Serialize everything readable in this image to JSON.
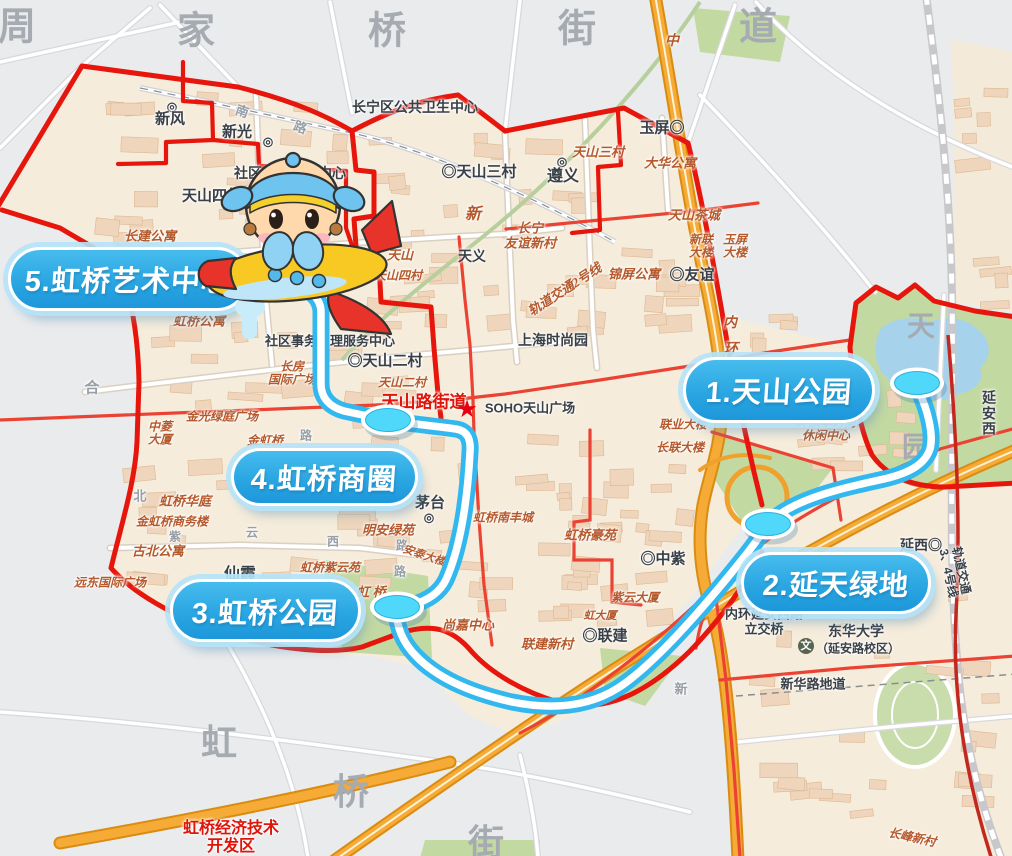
{
  "map_title": "天山路街道五站游览路线图",
  "route": {
    "stroke_color": "#32b8ee",
    "core_color": "#ffffff",
    "marker_color": "#4fd8f9",
    "path": "M 299,286 C 312,291 321,300 321,312 L 321,384 C 321,398 330,407 344,411 L 372,417 C 380,419 386,420 392,421 C 414,424 442,427 456,429 C 468,431 471,440 470,452 C 468,492 462,541 448,575 C 443,589 432,598 418,603 C 410,606 403,606 397,607 C 395,625 403,643 416,656 C 438,679 472,693 512,702 C 552,710 588,707 618,688 C 652,666 700,612 741,561 C 753,546 761,535 768,524 C 792,499 843,488 884,479 C 910,473 925,464 930,449 C 934,434 927,408 919,392",
    "stops": [
      {
        "id": 1,
        "label": "1.天山公园",
        "pill": {
          "x": 683,
          "y": 357,
          "w": 186,
          "h": 60
        },
        "marker": {
          "x": 917,
          "y": 383
        }
      },
      {
        "id": 2,
        "label": "2.延天绿地",
        "pill": {
          "x": 741,
          "y": 552,
          "w": 184,
          "h": 56
        },
        "marker": {
          "x": 768,
          "y": 524
        }
      },
      {
        "id": 3,
        "label": "3.虹桥公园",
        "pill": {
          "x": 170,
          "y": 579,
          "w": 185,
          "h": 57
        },
        "marker": {
          "x": 397,
          "y": 607
        }
      },
      {
        "id": 4,
        "label": "4.虹桥商圈",
        "pill": {
          "x": 231,
          "y": 448,
          "w": 181,
          "h": 52
        },
        "marker": {
          "x": 388,
          "y": 420
        }
      },
      {
        "id": 5,
        "label": "5.虹桥艺术中心",
        "pill": {
          "x": 8,
          "y": 247,
          "w": 235,
          "h": 58
        },
        "marker": null
      }
    ]
  },
  "mascot": {
    "type": "airplane-pilot-mascot",
    "note": "cartoon child in blue aviator cap riding yellow-red toy plane"
  },
  "labels": [
    {
      "t": "周",
      "x": 18,
      "y": 28,
      "c": "gxl",
      "s": 38
    },
    {
      "t": "家",
      "x": 197,
      "y": 32,
      "c": "gxl",
      "s": 38
    },
    {
      "t": "桥",
      "x": 388,
      "y": 32,
      "c": "gxl",
      "s": 38
    },
    {
      "t": "街",
      "x": 578,
      "y": 30,
      "c": "gxl",
      "s": 38
    },
    {
      "t": "道",
      "x": 759,
      "y": 28,
      "c": "gxl",
      "s": 38
    },
    {
      "t": "虹",
      "x": 220,
      "y": 743,
      "c": "gxl",
      "s": 36
    },
    {
      "t": "桥",
      "x": 352,
      "y": 792,
      "c": "gxl",
      "s": 36
    },
    {
      "t": "街",
      "x": 487,
      "y": 843,
      "c": "gxl",
      "s": 36
    },
    {
      "t": "天",
      "x": 922,
      "y": 327,
      "c": "gxl",
      "s": 28
    },
    {
      "t": "园",
      "x": 917,
      "y": 448,
      "c": "gxl",
      "s": 28
    },
    {
      "t": "合",
      "x": 92,
      "y": 389,
      "c": "gray",
      "s": 15
    },
    {
      "t": "南",
      "x": 242,
      "y": 112,
      "c": "gray",
      "s": 13,
      "r": 20
    },
    {
      "t": "路",
      "x": 300,
      "y": 128,
      "c": "gray",
      "s": 13,
      "r": 20
    },
    {
      "t": "北",
      "x": 140,
      "y": 497,
      "c": "gray",
      "s": 13
    },
    {
      "t": "紫",
      "x": 175,
      "y": 537,
      "c": "gray",
      "s": 12
    },
    {
      "t": "云",
      "x": 252,
      "y": 533,
      "c": "gray",
      "s": 12
    },
    {
      "t": "西",
      "x": 333,
      "y": 542,
      "c": "gray",
      "s": 12
    },
    {
      "t": "路",
      "x": 402,
      "y": 546,
      "c": "gray",
      "s": 12
    },
    {
      "t": "路",
      "x": 306,
      "y": 436,
      "c": "gray",
      "s": 12
    },
    {
      "t": "路",
      "x": 400,
      "y": 572,
      "c": "gray",
      "s": 12
    },
    {
      "t": "新",
      "x": 681,
      "y": 690,
      "c": "gray",
      "s": 13
    },
    {
      "t": "◎",
      "x": 172,
      "y": 107,
      "c": "dark",
      "s": 12
    },
    {
      "t": "新风",
      "x": 170,
      "y": 120,
      "c": "dark",
      "s": 15
    },
    {
      "t": "新光",
      "x": 237,
      "y": 133,
      "c": "dark",
      "s": 15
    },
    {
      "t": "◎",
      "x": 268,
      "y": 142,
      "c": "dark",
      "s": 12
    },
    {
      "t": "天山四村",
      "x": 212,
      "y": 197,
      "c": "dark",
      "s": 15
    },
    {
      "t": "社区卫生服务中心",
      "x": 290,
      "y": 174,
      "c": "dark",
      "s": 14
    },
    {
      "t": "长宁区公共卫生中心",
      "x": 415,
      "y": 108,
      "c": "dark",
      "s": 14
    },
    {
      "t": "◎天山三村",
      "x": 479,
      "y": 173,
      "c": "dark",
      "s": 15
    },
    {
      "t": "玉屏◎",
      "x": 662,
      "y": 129,
      "c": "dark",
      "s": 15
    },
    {
      "t": "◎",
      "x": 562,
      "y": 162,
      "c": "dark",
      "s": 12
    },
    {
      "t": "遵义",
      "x": 563,
      "y": 177,
      "c": "dark",
      "s": 16
    },
    {
      "t": "天义",
      "x": 472,
      "y": 257,
      "c": "dark",
      "s": 14
    },
    {
      "t": "◎友谊",
      "x": 692,
      "y": 276,
      "c": "dark",
      "s": 15
    },
    {
      "t": "上海时尚园",
      "x": 553,
      "y": 341,
      "c": "dark",
      "s": 14
    },
    {
      "t": "社区事务受理服务中心",
      "x": 330,
      "y": 342,
      "c": "dark",
      "s": 13
    },
    {
      "t": "◎天山二村",
      "x": 385,
      "y": 362,
      "c": "dark",
      "s": 15
    },
    {
      "t": "SOHO天山广场",
      "x": 530,
      "y": 409,
      "c": "dark",
      "s": 13
    },
    {
      "t": "茅台",
      "x": 430,
      "y": 504,
      "c": "dark",
      "s": 15
    },
    {
      "t": "◎",
      "x": 429,
      "y": 518,
      "c": "dark",
      "s": 12
    },
    {
      "t": "仙霞",
      "x": 240,
      "y": 575,
      "c": "dark",
      "s": 16
    },
    {
      "t": "◎中紫",
      "x": 663,
      "y": 560,
      "c": "dark",
      "s": 15
    },
    {
      "t": "◎联建",
      "x": 605,
      "y": 637,
      "c": "dark",
      "s": 15
    },
    {
      "t": "内环延安西路\n立交桥",
      "x": 764,
      "y": 622,
      "c": "dark",
      "s": 13
    },
    {
      "t": "东华大学",
      "x": 856,
      "y": 632,
      "c": "dark",
      "s": 14
    },
    {
      "t": "（延安路校区）",
      "x": 858,
      "y": 649,
      "c": "dark",
      "s": 12
    },
    {
      "t": "新华路地道",
      "x": 813,
      "y": 685,
      "c": "dark",
      "s": 13
    },
    {
      "t": "延西◎",
      "x": 921,
      "y": 546,
      "c": "dark",
      "s": 14
    },
    {
      "t": "轨道交通3、4号线",
      "x": 954,
      "y": 572,
      "c": "dark",
      "s": 12,
      "r": 78
    },
    {
      "t": "延安西",
      "x": 989,
      "y": 414,
      "c": "dark",
      "s": 14
    },
    {
      "t": "天山三村",
      "x": 598,
      "y": 153,
      "c": "red",
      "s": 13
    },
    {
      "t": "大华公寓",
      "x": 670,
      "y": 164,
      "c": "red",
      "s": 13
    },
    {
      "t": "天山茶城",
      "x": 694,
      "y": 216,
      "c": "red",
      "s": 13
    },
    {
      "t": "长宁\n友谊新村",
      "x": 530,
      "y": 236,
      "c": "red",
      "s": 13
    },
    {
      "t": "新联\n大楼",
      "x": 701,
      "y": 247,
      "c": "red",
      "s": 12
    },
    {
      "t": "玉屏\n大楼",
      "x": 735,
      "y": 247,
      "c": "red",
      "s": 12
    },
    {
      "t": "锦屏公寓",
      "x": 634,
      "y": 275,
      "c": "red",
      "s": 13
    },
    {
      "t": "轨道交通2号线",
      "x": 565,
      "y": 290,
      "c": "red",
      "s": 13,
      "r": -33
    },
    {
      "t": "山",
      "x": 373,
      "y": 236,
      "c": "red",
      "s": 16
    },
    {
      "t": "新",
      "x": 473,
      "y": 215,
      "c": "red",
      "s": 16
    },
    {
      "t": "天山",
      "x": 400,
      "y": 256,
      "c": "red",
      "s": 13
    },
    {
      "t": "天山四村",
      "x": 398,
      "y": 276,
      "c": "red",
      "s": 12
    },
    {
      "t": "长建公寓",
      "x": 150,
      "y": 237,
      "c": "red",
      "s": 13
    },
    {
      "t": "虹桥公寓",
      "x": 199,
      "y": 322,
      "c": "red",
      "s": 13
    },
    {
      "t": "天山二村",
      "x": 402,
      "y": 383,
      "c": "red",
      "s": 12
    },
    {
      "t": "长房\n国际广场",
      "x": 292,
      "y": 374,
      "c": "red",
      "s": 12
    },
    {
      "t": "金光绿庭广场",
      "x": 222,
      "y": 417,
      "c": "red",
      "s": 12
    },
    {
      "t": "中菱\n大厦",
      "x": 160,
      "y": 434,
      "c": "red",
      "s": 12
    },
    {
      "t": "金虹桥",
      "x": 265,
      "y": 441,
      "c": "red",
      "s": 12
    },
    {
      "t": "虹桥华庭",
      "x": 185,
      "y": 502,
      "c": "red",
      "s": 13
    },
    {
      "t": "金虹桥商务楼",
      "x": 172,
      "y": 522,
      "c": "red",
      "s": 12
    },
    {
      "t": "古北公寓",
      "x": 158,
      "y": 552,
      "c": "red",
      "s": 13
    },
    {
      "t": "远东国际广场",
      "x": 110,
      "y": 583,
      "c": "red",
      "s": 12
    },
    {
      "t": "明安绿苑",
      "x": 388,
      "y": 531,
      "c": "red",
      "s": 13
    },
    {
      "t": "虹桥南丰城",
      "x": 503,
      "y": 518,
      "c": "red",
      "s": 12
    },
    {
      "t": "安泰大楼",
      "x": 424,
      "y": 556,
      "c": "red",
      "s": 11,
      "r": 18
    },
    {
      "t": "虹桥紫云苑",
      "x": 330,
      "y": 568,
      "c": "red",
      "s": 12
    },
    {
      "t": "虹 桥",
      "x": 371,
      "y": 593,
      "c": "red",
      "s": 13
    },
    {
      "t": "尚嘉中心",
      "x": 468,
      "y": 626,
      "c": "red",
      "s": 13
    },
    {
      "t": "联建新村",
      "x": 547,
      "y": 645,
      "c": "red",
      "s": 13
    },
    {
      "t": "紫云大厦",
      "x": 635,
      "y": 598,
      "c": "red",
      "s": 12
    },
    {
      "t": "虹大厦",
      "x": 600,
      "y": 616,
      "c": "red",
      "s": 11
    },
    {
      "t": "虹桥豪苑",
      "x": 590,
      "y": 536,
      "c": "red",
      "s": 13
    },
    {
      "t": "联业大楼",
      "x": 683,
      "y": 425,
      "c": "red",
      "s": 12
    },
    {
      "t": "长联大楼",
      "x": 680,
      "y": 448,
      "c": "red",
      "s": 12
    },
    {
      "t": "环东华时尚\n休闲中心",
      "x": 826,
      "y": 430,
      "c": "red",
      "s": 12
    },
    {
      "t": "长峰新村",
      "x": 912,
      "y": 838,
      "c": "red",
      "s": 12,
      "r": 12
    },
    {
      "t": "中",
      "x": 672,
      "y": 42,
      "c": "red",
      "s": 14
    },
    {
      "t": "内",
      "x": 730,
      "y": 324,
      "c": "red",
      "s": 14
    },
    {
      "t": "环",
      "x": 731,
      "y": 350,
      "c": "red",
      "s": 14
    },
    {
      "t": "天山路街道",
      "x": 424,
      "y": 402,
      "c": "redbold",
      "s": 17
    },
    {
      "t": "★",
      "x": 467,
      "y": 410,
      "c": "star",
      "s": 21
    },
    {
      "t": "虹桥经济技术\n开发区",
      "x": 231,
      "y": 838,
      "c": "redbold",
      "s": 16
    },
    {
      "t": "文",
      "x": 806,
      "y": 646,
      "c": "school",
      "s": 11
    }
  ],
  "colors": {
    "background_gray": "#eaebed",
    "district_beige": "#f6ecdb",
    "building": "#eed5bb",
    "park_green": "#c3d9a2",
    "lake_blue": "#a6d2ec",
    "boundary_red": "#e7160c",
    "road_red": "#ea4333",
    "highway_orange": "#f5ab36",
    "route_cyan": "#32b8ee",
    "pill_blue": "#2aa6e2",
    "metro_red": "#c3281e"
  }
}
